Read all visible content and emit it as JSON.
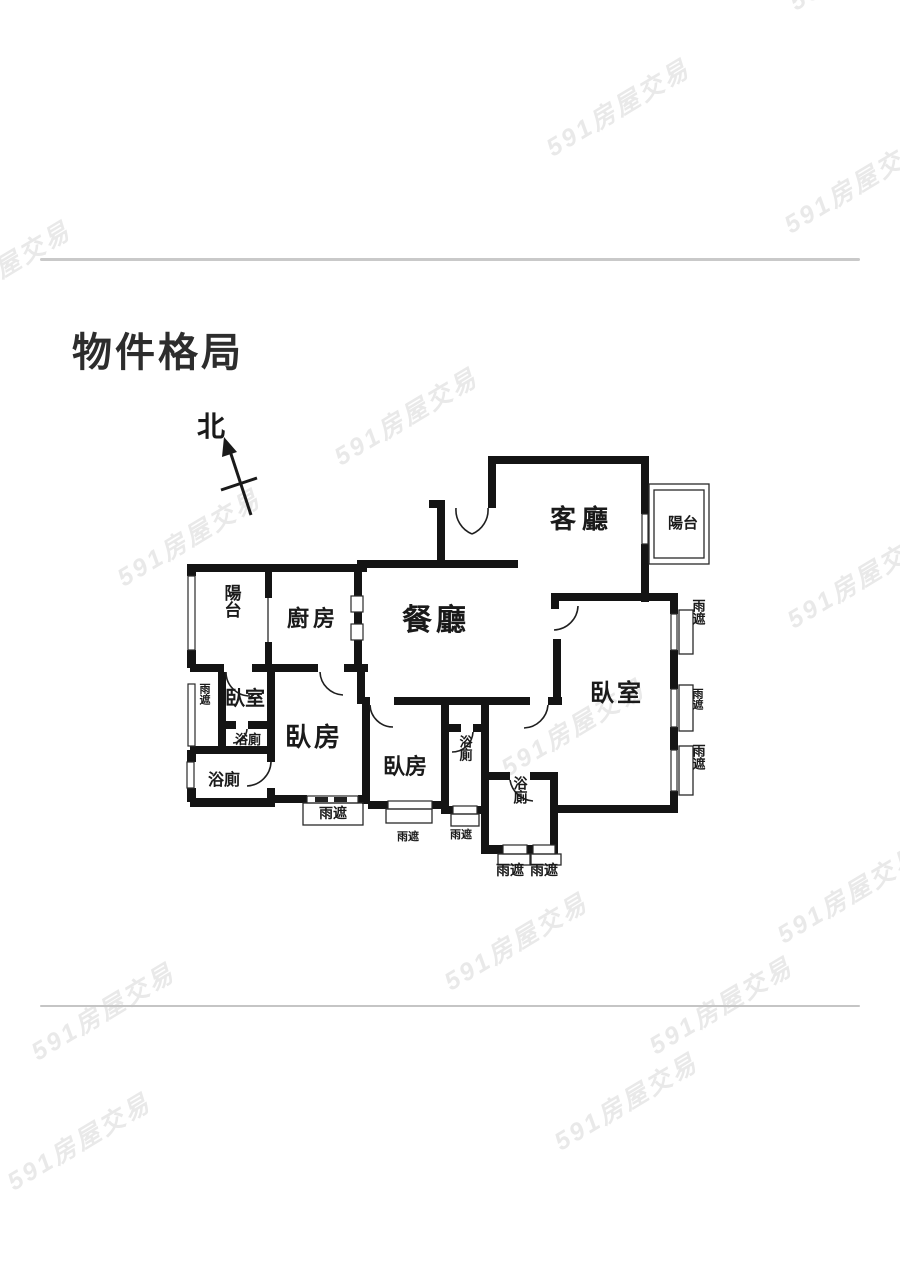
{
  "page": {
    "title": "物件格局",
    "watermark": "591房屋交易"
  },
  "compass": {
    "north_label": "北"
  },
  "floor_plan": {
    "labels": {
      "living_room": "客廳",
      "dining_room": "餐廳",
      "kitchen": "廚房",
      "balcony_right": "陽台",
      "balcony_left": "陽台",
      "bedroom_small": "臥室",
      "bedroom_left": "臥房",
      "bedroom_bottom": "臥房",
      "bedroom_master": "臥室",
      "bathroom": "浴廁",
      "awning": "雨遮"
    }
  },
  "colors": {
    "wall": "#141414",
    "divider": "#c9c9c9",
    "watermark": "#e9e9e9",
    "title_text": "#2d2d2d",
    "light_label": "#b5b5b5"
  }
}
